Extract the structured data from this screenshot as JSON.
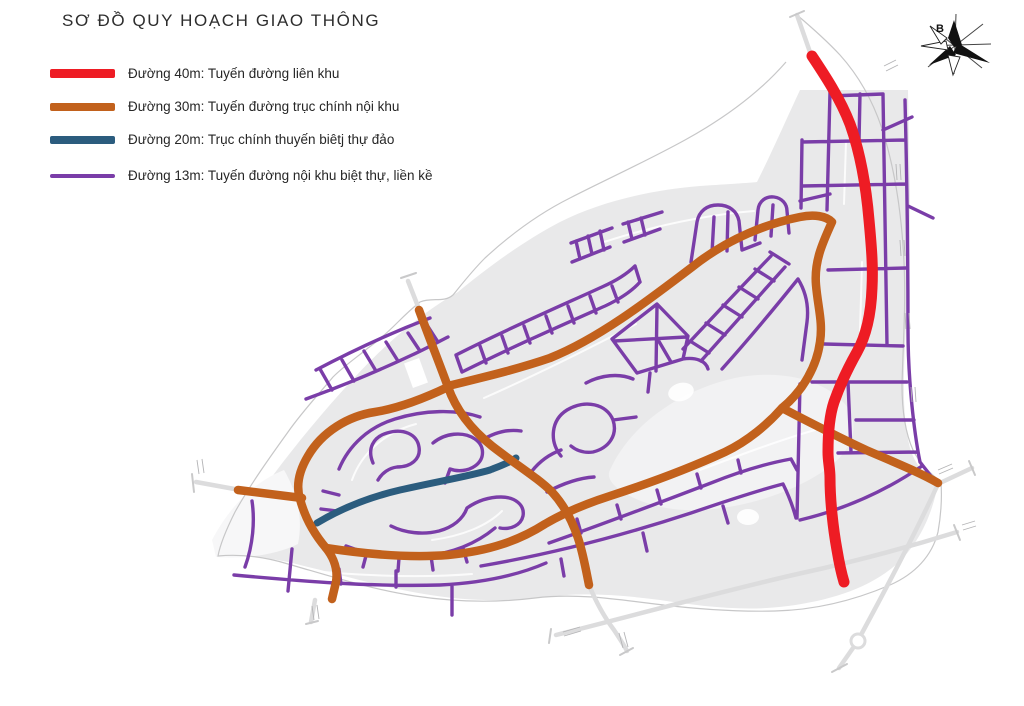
{
  "title": "SƠ ĐỒ QUY HOẠCH GIAO THÔNG",
  "compass": {
    "north_label": "B"
  },
  "legend": {
    "items": [
      {
        "id": "road-40m",
        "label": "Đường 40m: Tuyến đường liên khu",
        "color": "#ee1c24"
      },
      {
        "id": "road-30m",
        "label": "Đường 30m: Tuyến đường trục chính nội khu",
        "color": "#c2611c"
      },
      {
        "id": "road-20m",
        "label": "Đường 20m: Trục chính thuyến biêtj thự đảo",
        "color": "#2b5c7e"
      },
      {
        "id": "road-13m",
        "label": "Đường 13m: Tuyến đường nội khu biệt thự, liền kề",
        "color": "#7a3da8"
      }
    ]
  },
  "map": {
    "colors": {
      "road_40m": "#ee1c24",
      "road_30m": "#c2611c",
      "road_20m": "#2b5c7e",
      "road_13m": "#7a3da8",
      "minor_road": "#dcdcdd",
      "boundary": "#c7c7c8",
      "land": "#e9e9ea",
      "land_light": "#f2f2f3",
      "compass_ink": "#111111"
    }
  }
}
